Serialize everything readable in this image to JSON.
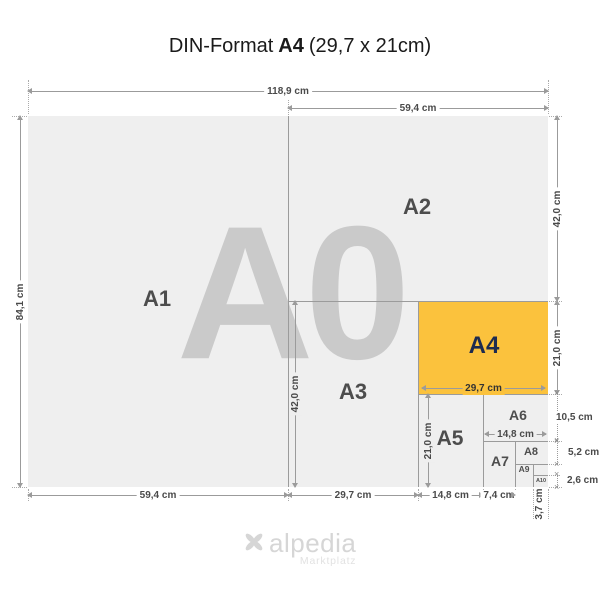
{
  "title": {
    "prefix": "DIN-Format",
    "format": "A4",
    "suffix": "(29,7 x 21cm)"
  },
  "logo": {
    "name": "alpedia",
    "subtitle": "Marktplatz"
  },
  "colors": {
    "background": "#ffffff",
    "sheet_fill": "#efefef",
    "a4_fill": "#fbc23d",
    "line": "#9b9b9b",
    "watermark": "#cacaca",
    "label": "#4d4d4d",
    "a4_label": "#1d2b4f",
    "dim_text": "#4a4a4a",
    "logo_gray": "#d6d6d6"
  },
  "diagram": {
    "watermark": "A0",
    "sheets": [
      {
        "id": "a0",
        "x": 28,
        "y": 116,
        "w": 520,
        "h": 371,
        "fill": "#efefef"
      },
      {
        "id": "a4",
        "x": 418,
        "y": 301,
        "w": 130,
        "h": 93,
        "fill": "#fbc23d"
      }
    ],
    "lines": [
      {
        "dir": "v",
        "x": 288,
        "y": 116,
        "len": 371
      },
      {
        "dir": "h",
        "x": 288,
        "y": 301,
        "len": 260
      },
      {
        "dir": "v",
        "x": 418,
        "y": 301,
        "len": 186
      },
      {
        "dir": "h",
        "x": 418,
        "y": 394,
        "len": 130
      },
      {
        "dir": "v",
        "x": 483,
        "y": 394,
        "len": 93
      },
      {
        "dir": "h",
        "x": 483,
        "y": 441,
        "len": 65
      },
      {
        "dir": "v",
        "x": 515,
        "y": 441,
        "len": 46
      },
      {
        "dir": "h",
        "x": 515,
        "y": 464,
        "len": 33
      },
      {
        "dir": "v",
        "x": 533,
        "y": 464,
        "len": 23
      },
      {
        "dir": "h",
        "x": 533,
        "y": 475,
        "len": 15
      }
    ],
    "labels": [
      {
        "id": "a1",
        "text": "A1",
        "x": 157,
        "y": 299,
        "fs": 22
      },
      {
        "id": "a2",
        "text": "A2",
        "x": 417,
        "y": 207,
        "fs": 22
      },
      {
        "id": "a3",
        "text": "A3",
        "x": 353,
        "y": 392,
        "fs": 22
      },
      {
        "id": "a4",
        "text": "A4",
        "x": 484,
        "y": 346,
        "fs": 24,
        "color": "#1d2b4f"
      },
      {
        "id": "a5",
        "text": "A5",
        "x": 450,
        "y": 439,
        "fs": 21
      },
      {
        "id": "a6",
        "text": "A6",
        "x": 518,
        "y": 415,
        "fs": 14
      },
      {
        "id": "a7",
        "text": "A7",
        "x": 500,
        "y": 461,
        "fs": 14
      },
      {
        "id": "a8",
        "text": "A8",
        "x": 531,
        "y": 452,
        "fs": 11
      },
      {
        "id": "a9",
        "text": "A9",
        "x": 524,
        "y": 469,
        "fs": 8.5
      },
      {
        "id": "a10",
        "text": "A10",
        "x": 541,
        "y": 481,
        "fs": 5.5
      }
    ],
    "dims": [
      {
        "id": "width-a0-top",
        "text": "118,9 cm",
        "dir": "h",
        "x": 28,
        "y": 91,
        "len": 520,
        "bg": "#ffffff"
      },
      {
        "id": "width-a2-top",
        "text": "59,4 cm",
        "dir": "h",
        "x": 288,
        "y": 108,
        "len": 260,
        "bg": "#ffffff"
      },
      {
        "id": "height-a0-left",
        "text": "84,1 cm",
        "dir": "v",
        "x": 20,
        "y": 116,
        "len": 371,
        "bg": "#ffffff"
      },
      {
        "id": "height-a2-right",
        "text": "42,0 cm",
        "dir": "v",
        "x": 557,
        "y": 116,
        "len": 185,
        "bg": "#ffffff"
      },
      {
        "id": "height-a4-right",
        "text": "21,0 cm",
        "dir": "v",
        "x": 557,
        "y": 301,
        "len": 93,
        "bg": "#ffffff"
      },
      {
        "id": "height-a6-right",
        "text": "10,5 cm",
        "dir": "tick",
        "x": 557,
        "y": 394,
        "len": 47,
        "dx": -5
      },
      {
        "id": "height-a8-right",
        "text": "5,2 cm",
        "dir": "tick",
        "x": 557,
        "y": 441,
        "len": 23,
        "dx": 7
      },
      {
        "id": "height-a10-right",
        "text": "2,6 cm",
        "dir": "tick",
        "x": 557,
        "y": 475,
        "len": 12,
        "dx": 6
      },
      {
        "id": "width-a1-bottom",
        "text": "59,4 cm",
        "dir": "h",
        "x": 28,
        "y": 495,
        "len": 260,
        "bg": "#ffffff"
      },
      {
        "id": "width-a3-bottom",
        "text": "29,7 cm",
        "dir": "h",
        "x": 288,
        "y": 495,
        "len": 130,
        "bg": "#ffffff"
      },
      {
        "id": "width-a5-bottom",
        "text": "14,8 cm",
        "dir": "h",
        "x": 418,
        "y": 495,
        "len": 65,
        "bg": "#ffffff"
      },
      {
        "id": "width-a7-bottom",
        "text": "7,4 cm",
        "dir": "h",
        "x": 483,
        "y": 495,
        "len": 32,
        "bg": "#ffffff"
      },
      {
        "id": "width-a10-bottom",
        "text": "3,7 cm",
        "dir": "vtext",
        "x": 540,
        "y": 504
      },
      {
        "id": "height-a3-inner",
        "text": "42,0 cm",
        "dir": "v",
        "x": 295,
        "y": 301,
        "len": 186,
        "bg": "#efefef"
      },
      {
        "id": "height-a5-inner",
        "text": "21,0 cm",
        "dir": "v",
        "x": 428,
        "y": 394,
        "len": 93,
        "bg": "#efefef"
      },
      {
        "id": "width-a4-inner",
        "text": "29,7 cm",
        "dir": "h",
        "x": 422,
        "y": 388,
        "len": 123,
        "bg": "#fbc23d",
        "color": "#333333",
        "bold": true
      },
      {
        "id": "width-a6-inner",
        "text": "14,8 cm",
        "dir": "h",
        "x": 485,
        "y": 434,
        "len": 61,
        "bg": "#efefef"
      }
    ],
    "exts": [
      {
        "dir": "v",
        "x": 28,
        "y": 80,
        "len": 34
      },
      {
        "dir": "v",
        "x": 548,
        "y": 80,
        "len": 34
      },
      {
        "dir": "v",
        "x": 288,
        "y": 100,
        "len": 15
      },
      {
        "dir": "v",
        "x": 28,
        "y": 489,
        "len": 12
      },
      {
        "dir": "v",
        "x": 288,
        "y": 489,
        "len": 12
      },
      {
        "dir": "v",
        "x": 418,
        "y": 489,
        "len": 12
      },
      {
        "dir": "v",
        "x": 483,
        "y": 489,
        "len": 12
      },
      {
        "dir": "v",
        "x": 515,
        "y": 489,
        "len": 12
      },
      {
        "dir": "v",
        "x": 533,
        "y": 489,
        "len": 30
      },
      {
        "dir": "v",
        "x": 548,
        "y": 489,
        "len": 30
      },
      {
        "dir": "h",
        "x": 12,
        "y": 116,
        "len": 15
      },
      {
        "dir": "h",
        "x": 12,
        "y": 487,
        "len": 15
      },
      {
        "dir": "h",
        "x": 549,
        "y": 116,
        "len": 13
      },
      {
        "dir": "h",
        "x": 549,
        "y": 301,
        "len": 13
      },
      {
        "dir": "h",
        "x": 549,
        "y": 394,
        "len": 13
      },
      {
        "dir": "h",
        "x": 549,
        "y": 441,
        "len": 13
      },
      {
        "dir": "h",
        "x": 549,
        "y": 464,
        "len": 13
      },
      {
        "dir": "h",
        "x": 549,
        "y": 475,
        "len": 11
      },
      {
        "dir": "h",
        "x": 549,
        "y": 487,
        "len": 13
      }
    ]
  }
}
